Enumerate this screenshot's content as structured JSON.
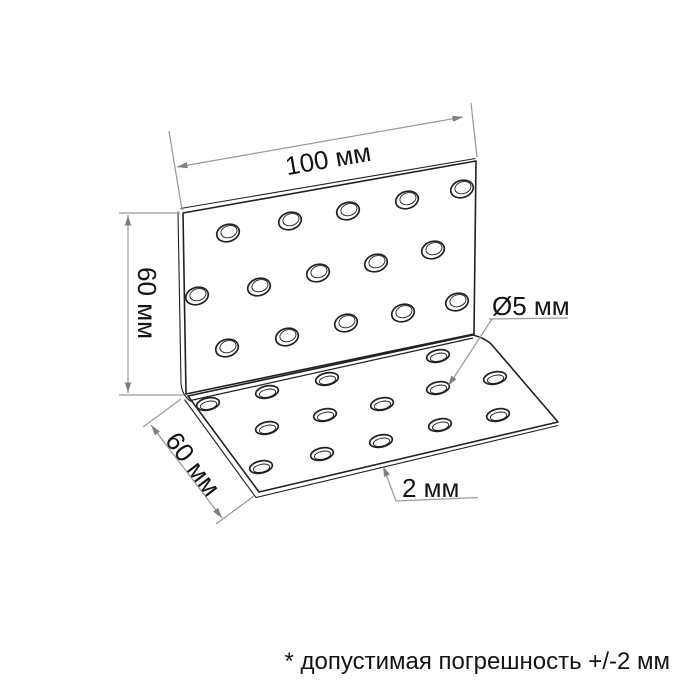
{
  "labels": {
    "width": "100 мм",
    "height": "60 мм",
    "depth": "60 мм",
    "hole_diameter": "Ø5 мм",
    "thickness": "2 мм"
  },
  "note": "* допустимая погрешность +/-2 мм",
  "values_mm": {
    "width": 100,
    "height": 60,
    "depth": 60,
    "hole_diameter": 5,
    "thickness": 2,
    "tolerance": "+/-2"
  },
  "colors": {
    "background": "#ffffff",
    "outline": "#212121",
    "dimension_lines": "#9a9a9a",
    "text": "#141414"
  },
  "holes": {
    "vertical_plate": {
      "count": 15,
      "rx": 11.5,
      "ry": 8.5,
      "tilt": -17,
      "inner_dx": 1.3,
      "inner_dy": -1.0,
      "inner_rx": 8.2,
      "inner_ry": 5.9,
      "centers": [
        [
          228,
          233
        ],
        [
          290,
          221
        ],
        [
          348,
          211
        ],
        [
          407,
          200
        ],
        [
          462,
          189
        ],
        [
          197,
          296
        ],
        [
          259,
          287
        ],
        [
          318,
          273
        ],
        [
          376,
          263
        ],
        [
          433,
          250
        ],
        [
          227,
          348
        ],
        [
          287,
          337
        ],
        [
          346,
          323
        ],
        [
          403,
          313
        ],
        [
          457,
          302
        ]
      ]
    },
    "base_plate": {
      "count": 14,
      "rx": 11.5,
      "ry": 6.0,
      "tilt": -12,
      "inner_dx": 0.3,
      "inner_dy": 1.3,
      "inner_rx": 8.3,
      "inner_ry": 3.9,
      "centers": [
        [
          208,
          404
        ],
        [
          267,
          392
        ],
        [
          327,
          379
        ],
        [
          438,
          356
        ],
        [
          267,
          428
        ],
        [
          325,
          415
        ],
        [
          382,
          404
        ],
        [
          438,
          388
        ],
        [
          495,
          378
        ],
        [
          261,
          467
        ],
        [
          322,
          454
        ],
        [
          381,
          441
        ],
        [
          440,
          425
        ],
        [
          498,
          415
        ]
      ]
    }
  }
}
